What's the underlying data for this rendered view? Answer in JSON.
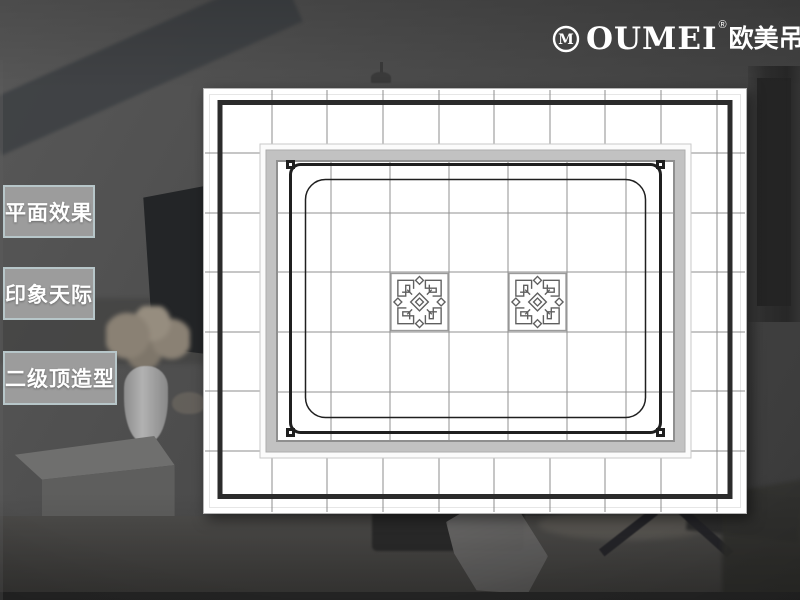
{
  "brand": {
    "monogram": "M",
    "name": "OUMEI",
    "registered": "®",
    "cjk_name": "欧美吊顶"
  },
  "sidebar": {
    "items": [
      {
        "label": "平面效果"
      },
      {
        "label": "印象天际"
      },
      {
        "label": "二级顶造型"
      }
    ]
  },
  "colors": {
    "background_wall": "#4c4c4c",
    "panel_white": "#ffffff",
    "outer_border_black": "#2b2b2b",
    "grid_line": "#8c8c8c",
    "decor_line": "#1f1f1f",
    "recess_band": "#c2c2c2",
    "label_fill": "#9c9c9c",
    "label_border": "#b7c6c9",
    "label_text": "#ffffff",
    "logo_text": "#ffffff"
  },
  "plan": {
    "outer_grid": {
      "vertical_x": [
        69,
        124,
        180,
        236,
        291,
        347,
        402,
        458,
        514
      ],
      "horizontal_y": [
        65,
        125,
        184,
        244,
        303,
        363
      ],
      "x_range": [
        2,
        542
      ],
      "y_range": [
        2,
        424
      ]
    },
    "inner_grid": {
      "vertical_x": [
        128,
        187,
        246,
        305,
        364,
        423
      ],
      "horizontal_y": [
        125,
        184,
        244,
        304
      ],
      "x_range": [
        74,
        471
      ],
      "y_range": [
        73,
        353
      ]
    },
    "corner_squares": [
      [
        87.5,
        76.5
      ],
      [
        457.5,
        76.5
      ],
      [
        87.5,
        344.5
      ],
      [
        457.5,
        344.5
      ]
    ],
    "ornaments": [
      {
        "x": 187,
        "y": 184.5,
        "w": 59,
        "h": 59
      },
      {
        "x": 305,
        "y": 184.5,
        "w": 59,
        "h": 59
      }
    ]
  }
}
